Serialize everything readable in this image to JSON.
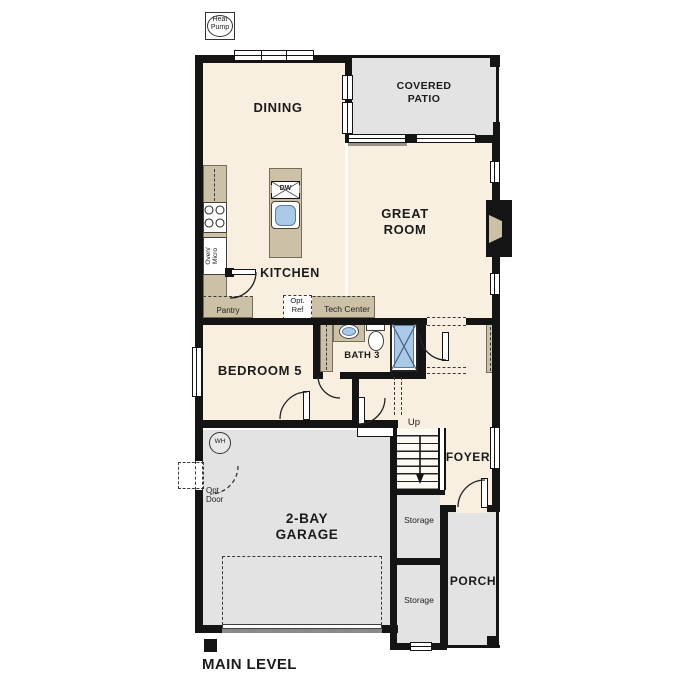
{
  "plan_title": "MAIN LEVEL",
  "labels": {
    "heat_pump": {
      "line1": "Heat",
      "line2": "Pump"
    },
    "dining": "DINING",
    "covered_patio": {
      "line1": "COVERED",
      "line2": "PATIO"
    },
    "great_room": {
      "line1": "GREAT",
      "line2": "ROOM"
    },
    "kitchen": "KITCHEN",
    "bedroom_5": "BEDROOM 5",
    "bath_3": "BATH 3",
    "foyer": "FOYER",
    "garage": {
      "line1": "2-BAY",
      "line2": "GARAGE"
    },
    "porch": "PORCH",
    "storage_upper": "Storage",
    "storage_lower": "Storage",
    "pantry": "Pantry",
    "tech_center": "Tech Center",
    "opt_ref": {
      "line1": "Opt.",
      "line2": "Ref"
    },
    "opt_door": {
      "line1": "Opt.",
      "line2": "Door"
    },
    "oven_micro": {
      "line1": "Oven/",
      "line2": "Micro"
    },
    "dishwasher": "DW",
    "water_heater": "WH",
    "stairs": "Up"
  },
  "colors": {
    "wall": "#141414",
    "interior_floor": "#f8efe0",
    "outdoor_gray": "#e3e3e3",
    "cabinet_tan": "#ccc0a6",
    "plumbing_blue": "#a9c9e6"
  }
}
